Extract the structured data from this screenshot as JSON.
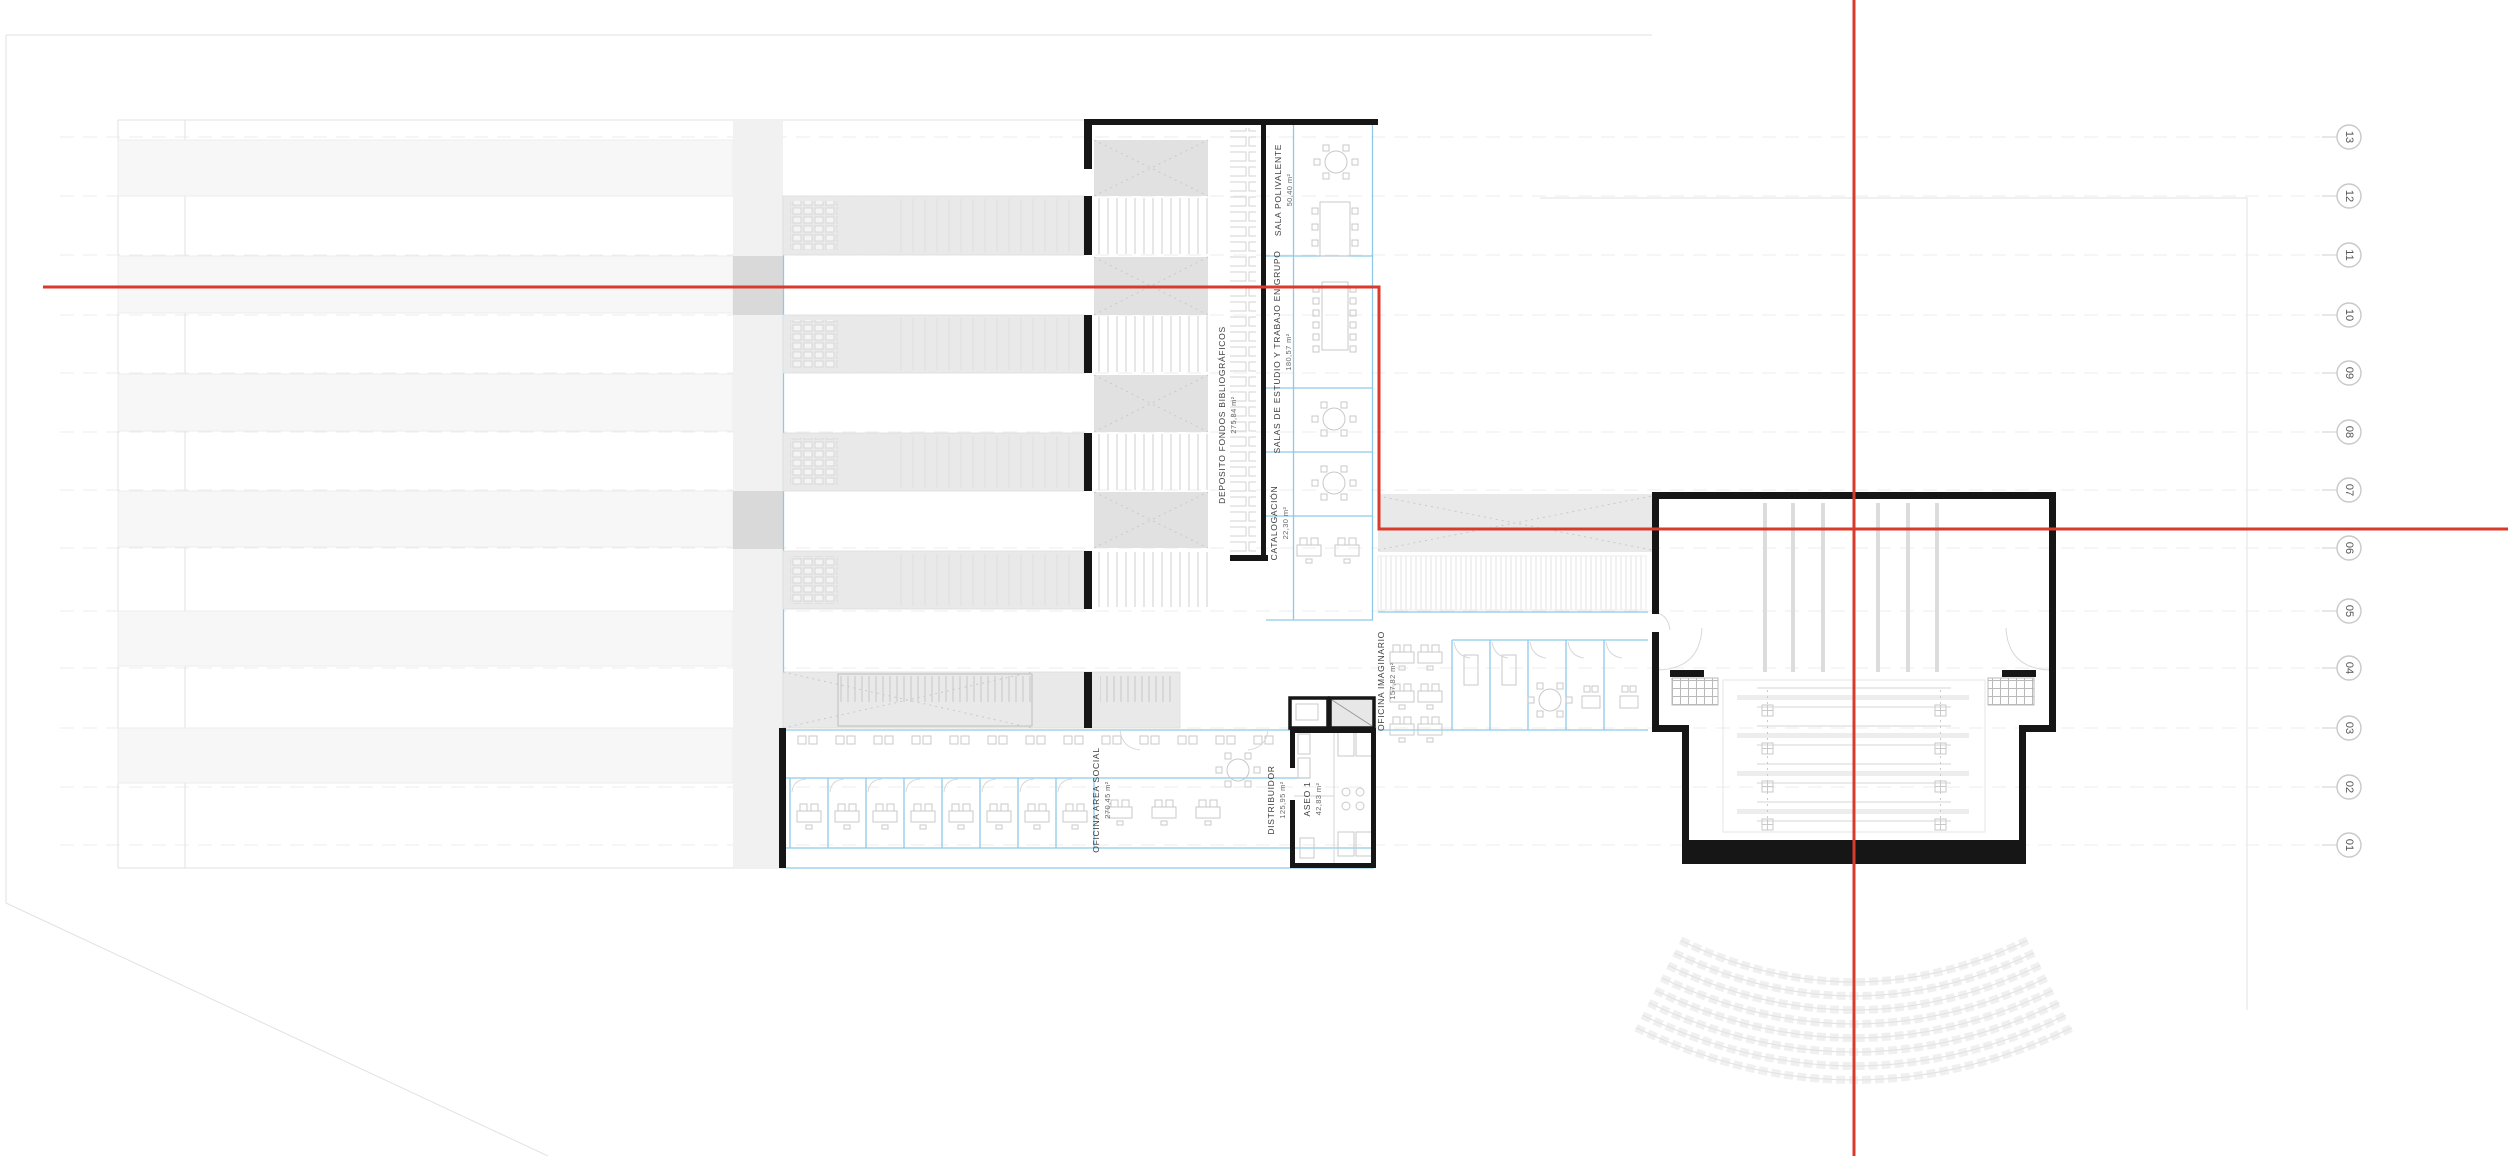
{
  "drawing": {
    "title": "planta - biblioteca / floor plan",
    "rooms": [
      {
        "name": "SALA POLIVALENTE",
        "area": "50,40 m²"
      },
      {
        "name": "DEPOSITO FONDOS BIBLIOGRÁFICOS",
        "area": "275,84 m²"
      },
      {
        "name": "SALAS DE ESTUDIO Y TRABAJO EN GRUPO",
        "area": "180,57 m²"
      },
      {
        "name": "CATALOGACIÓN",
        "area": "22,30 m²"
      },
      {
        "name": "OFICINA IMAGINARIO",
        "area": "157,82 m²"
      },
      {
        "name": "OFICINA AREA SOCIAL",
        "area": "270,45 m²"
      },
      {
        "name": "DISTRIBUIDOR",
        "area": "125,95 m²"
      },
      {
        "name": "ASEO 1",
        "area": "42,83 m²"
      }
    ],
    "grid_axis": {
      "labels": [
        "13",
        "12",
        "11",
        "10",
        "09",
        "08",
        "07",
        "06",
        "05",
        "04",
        "03",
        "02",
        "01"
      ]
    },
    "colors": {
      "section_line_red": "#d93a2b",
      "cad_blue": "#8ec9e9",
      "wall_black": "#161616",
      "band_grey": "#e9e9e9"
    }
  }
}
